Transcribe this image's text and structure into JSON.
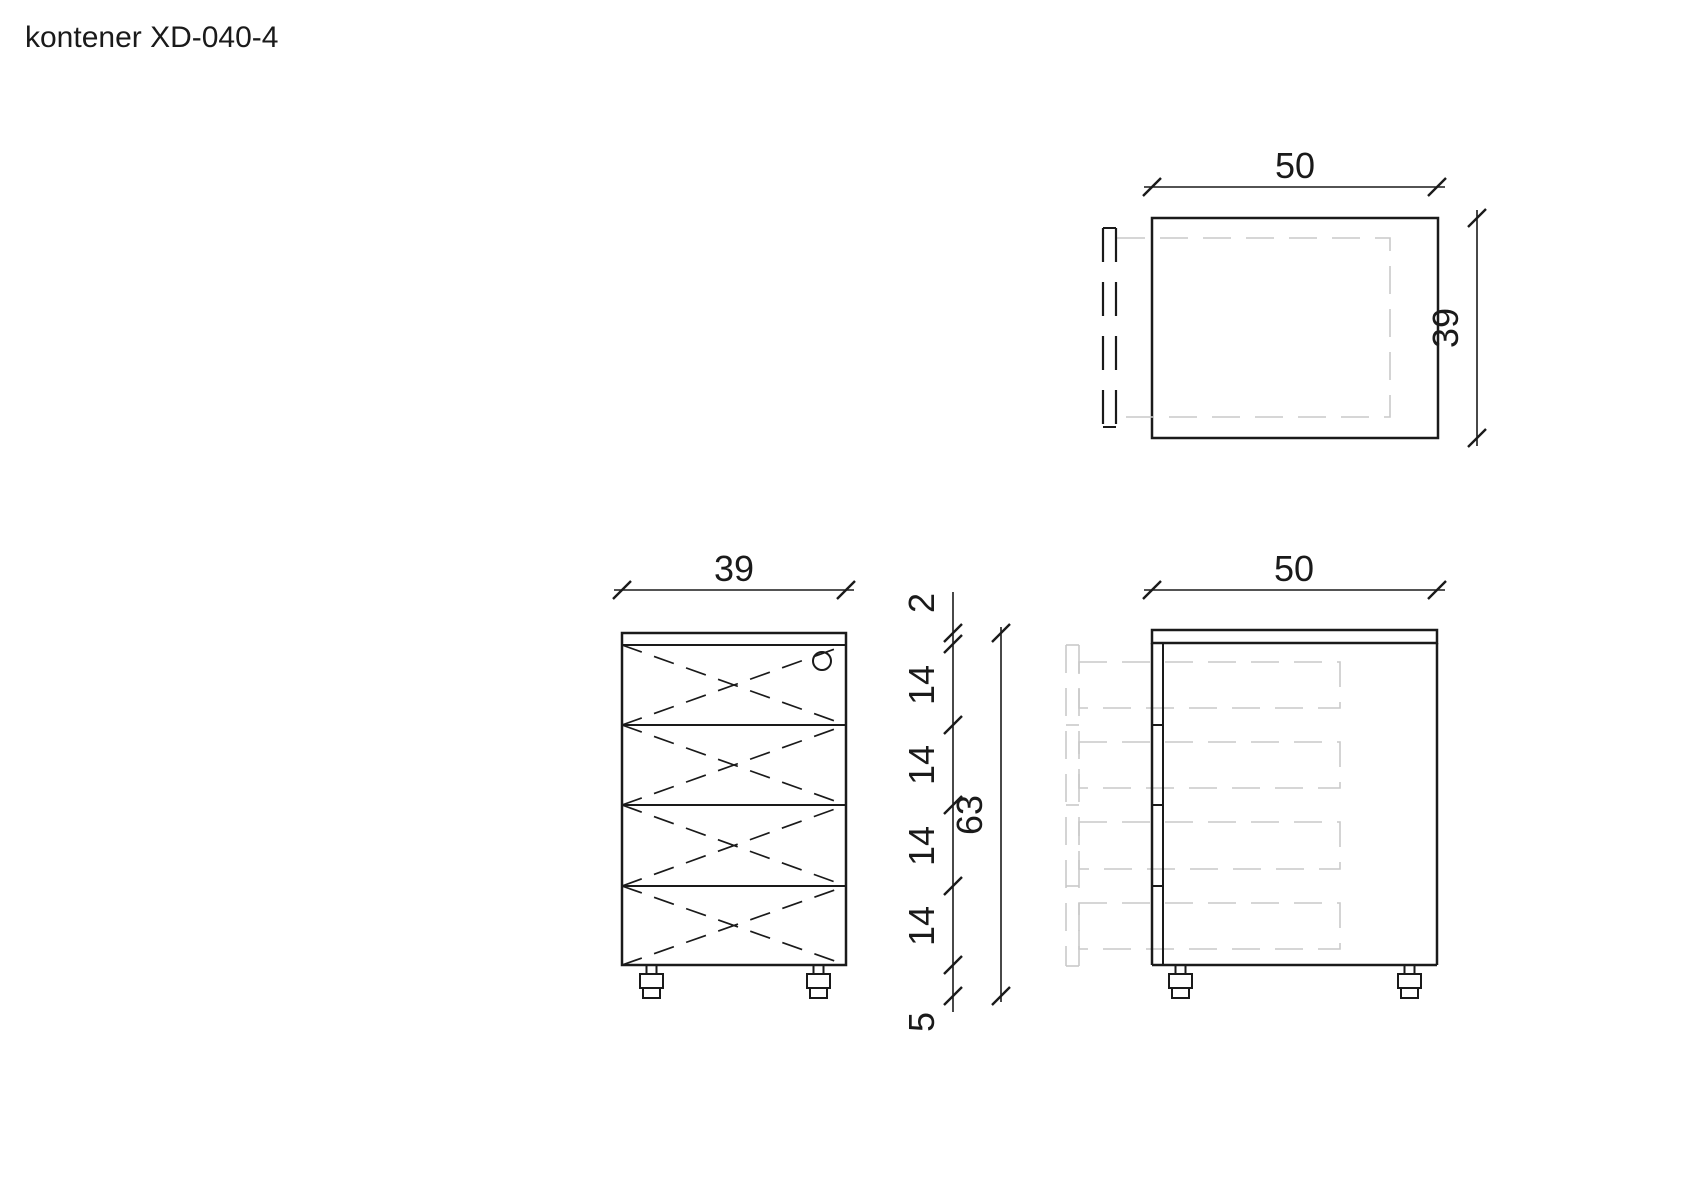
{
  "title": "kontener XD-040-4",
  "colors": {
    "line": "#1a1a1a",
    "phantom": "#c9c9c9"
  },
  "dimensions": {
    "top_view": {
      "width": "50",
      "depth": "39"
    },
    "front_view": {
      "width": "39"
    },
    "side_view": {
      "width": "50"
    },
    "height_chain": {
      "segments": [
        "2",
        "14",
        "14",
        "14",
        "14",
        "5"
      ],
      "total": "63"
    }
  }
}
